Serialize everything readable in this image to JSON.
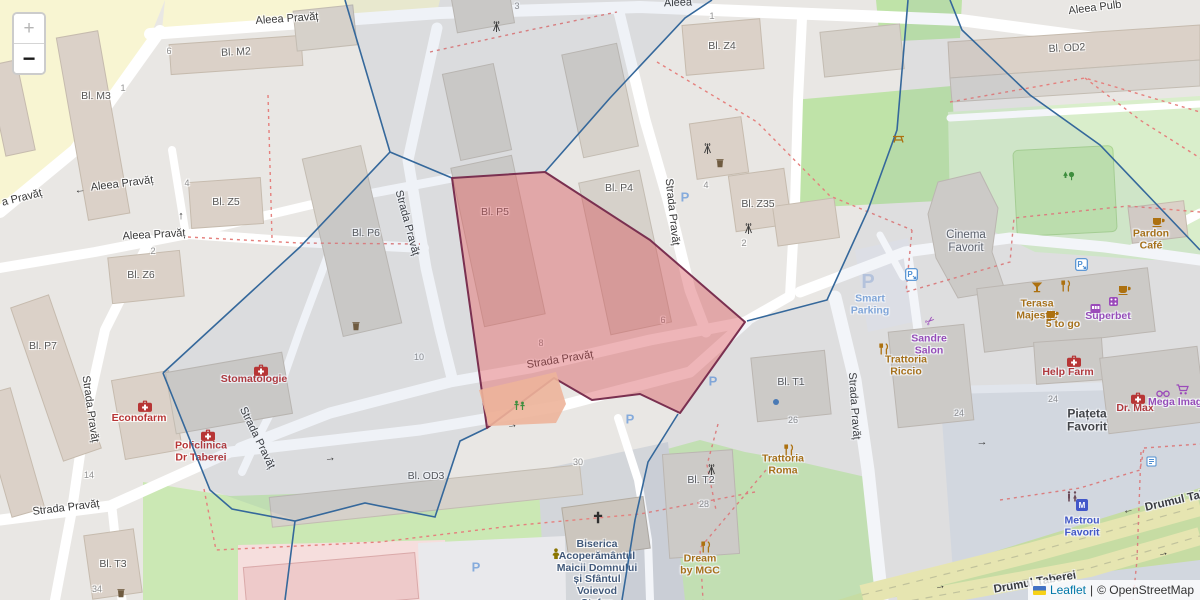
{
  "controls": {
    "zoom_in": "+",
    "zoom_out": "−"
  },
  "attribution": {
    "leaflet": "Leaflet",
    "separator": "|",
    "osm": "© OpenStreetMap"
  },
  "colors": {
    "street_label": "#383838",
    "building_label": "#575757",
    "number_gray": "#8f8f8f",
    "poi_red": "#b73535",
    "poi_orange": "#ad7110",
    "poi_purple": "#9b4bba",
    "parking_blue": "#85abdc",
    "parking_faint": "#bcc9e0",
    "metro_blue": "#4257c9",
    "church_label": "#41597a",
    "cinema_gray": "#5d6067",
    "green_icon": "#3e8e3e",
    "boundary_blue": "#35689b",
    "dashed_red": "#e5807d",
    "selection_fill": "#d64e56",
    "selection_stroke": "#7a3050",
    "leaflet_link": "#0078a8"
  },
  "street_labels": [
    {
      "n": "street-aleea-pravat-top",
      "t": "Aleea Pravăț",
      "x": 287,
      "y": 19,
      "r": -4
    },
    {
      "n": "street-aleea-pulb",
      "t": "Aleea Pulb",
      "x": 1095,
      "y": 8,
      "r": -7
    },
    {
      "n": "street-aleea-partial",
      "t": "Aleea",
      "x": 678,
      "y": 3,
      "r": -2
    },
    {
      "n": "street-a-pravat-left",
      "t": "a Pravăț",
      "x": 22,
      "y": 198,
      "r": -14
    },
    {
      "n": "street-aleea-pravat-west",
      "t": "Aleea Pravăț",
      "x": 122,
      "y": 184,
      "r": -7
    },
    {
      "n": "street-aleea-pravat-mid",
      "t": "Aleea Pravăț",
      "x": 154,
      "y": 235,
      "r": -3
    },
    {
      "n": "street-strada-pravat-left",
      "t": "Strada Pravăț",
      "x": 90,
      "y": 409,
      "r": 82
    },
    {
      "n": "street-strada-pravat-n",
      "t": "Strada Pravăț",
      "x": 407,
      "y": 223,
      "r": 75
    },
    {
      "n": "street-strada-pravat-ne",
      "t": "Strada Pravăț",
      "x": 672,
      "y": 212,
      "r": 84
    },
    {
      "n": "street-strada-pravat-h",
      "t": "Strada Pravăț",
      "x": 560,
      "y": 360,
      "r": -9
    },
    {
      "n": "street-strada-pravat-curve",
      "t": "Strada Pravăț",
      "x": 257,
      "y": 438,
      "r": 64
    },
    {
      "n": "street-strada-pravat-s",
      "t": "Strada Pravăț",
      "x": 854,
      "y": 406,
      "r": 86
    },
    {
      "n": "street-strada-pravat-sw",
      "t": "Strada Pravăț",
      "x": 66,
      "y": 508,
      "r": -7
    },
    {
      "n": "street-drumul-taberei-ne",
      "t": "Drumul Taberei",
      "x": 1186,
      "y": 499,
      "r": -13,
      "cls": "major"
    },
    {
      "n": "street-drumul-taberei-s",
      "t": "Drumul Taberei",
      "x": 1035,
      "y": 583,
      "r": -10,
      "cls": "major"
    }
  ],
  "building_labels": [
    {
      "n": "bldg-label-m2",
      "t": "Bl. M2",
      "x": 236,
      "y": 53,
      "r": -3
    },
    {
      "n": "bldg-label-m3",
      "t": "Bl. M3",
      "x": 96,
      "y": 97,
      "r": 0
    },
    {
      "n": "bldg-label-z5",
      "t": "Bl. Z5",
      "x": 226,
      "y": 203,
      "r": 0
    },
    {
      "n": "bldg-label-z6",
      "t": "Bl. Z6",
      "x": 141,
      "y": 276,
      "r": 0
    },
    {
      "n": "bldg-label-p7",
      "t": "Bl. P7",
      "x": 43,
      "y": 347,
      "r": 0
    },
    {
      "n": "bldg-label-p6",
      "t": "Bl. P6",
      "x": 366,
      "y": 234,
      "r": 0
    },
    {
      "n": "bldg-label-p5",
      "t": "Bl. P5",
      "x": 495,
      "y": 213,
      "r": 0
    },
    {
      "n": "bldg-label-p4",
      "t": "Bl. P4",
      "x": 619,
      "y": 189,
      "r": 0
    },
    {
      "n": "bldg-label-z4",
      "t": "Bl. Z4",
      "x": 722,
      "y": 47,
      "r": 0
    },
    {
      "n": "bldg-label-z35",
      "t": "Bl. Z35",
      "x": 758,
      "y": 205,
      "r": 0
    },
    {
      "n": "bldg-label-t1",
      "t": "Bl. T1",
      "x": 791,
      "y": 383,
      "r": 0
    },
    {
      "n": "bldg-label-t2",
      "t": "Bl. T2",
      "x": 701,
      "y": 481,
      "r": 0
    },
    {
      "n": "bldg-label-t3",
      "t": "Bl. T3",
      "x": 113,
      "y": 565,
      "r": 0
    },
    {
      "n": "bldg-label-od3",
      "t": "Bl. OD3",
      "x": 426,
      "y": 477,
      "r": 0
    },
    {
      "n": "bldg-label-od2",
      "t": "Bl. OD2",
      "x": 1067,
      "y": 49,
      "r": -3
    }
  ],
  "place_labels": [
    {
      "n": "place-cinema-favorit",
      "lines": [
        "Cinema",
        "Favorit"
      ],
      "x": 966,
      "y": 242
    },
    {
      "n": "place-piateta-favorit",
      "lines": [
        "Piațeta",
        "Favorit"
      ],
      "x": 1087,
      "y": 421,
      "cls": "piateta"
    }
  ],
  "poi_labels": [
    {
      "n": "poi-econofarm",
      "lines": [
        "Econofarm"
      ],
      "x": 139,
      "y": 419,
      "cls": "red"
    },
    {
      "n": "poi-stomatologie",
      "lines": [
        "Stomatologie"
      ],
      "x": 254,
      "y": 380,
      "cls": "red"
    },
    {
      "n": "poi-policlinica",
      "lines": [
        "Policlinica",
        "Dr Taberei"
      ],
      "x": 201,
      "y": 452,
      "cls": "red"
    },
    {
      "n": "poi-help-farm",
      "lines": [
        "Help Farm"
      ],
      "x": 1068,
      "y": 373,
      "cls": "red"
    },
    {
      "n": "poi-dr-max",
      "lines": [
        "Dr. Max"
      ],
      "x": 1135,
      "y": 409,
      "cls": "red"
    },
    {
      "n": "poi-trattoria-roma",
      "lines": [
        "Trattoria",
        "Roma"
      ],
      "x": 783,
      "y": 465,
      "cls": "orange"
    },
    {
      "n": "poi-trattoria-riccio",
      "lines": [
        "Trattoria",
        "Riccio"
      ],
      "x": 906,
      "y": 366,
      "cls": "orange"
    },
    {
      "n": "poi-dream-by-mgc",
      "lines": [
        "Dream",
        "by MGC"
      ],
      "x": 700,
      "y": 565,
      "cls": "orange"
    },
    {
      "n": "poi-terasa-majestic",
      "lines": [
        "Terasa",
        "Majestic"
      ],
      "x": 1037,
      "y": 310,
      "cls": "orange"
    },
    {
      "n": "poi-five-to-go",
      "lines": [
        "5 to go"
      ],
      "x": 1063,
      "y": 325,
      "cls": "orange"
    },
    {
      "n": "poi-pardon-cafe",
      "lines": [
        "Pardon",
        "Café"
      ],
      "x": 1151,
      "y": 240,
      "cls": "orange"
    },
    {
      "n": "poi-sandre-salon",
      "lines": [
        "Sandre",
        "Salon"
      ],
      "x": 929,
      "y": 345,
      "cls": "purple"
    },
    {
      "n": "poi-superbet",
      "lines": [
        "Superbet"
      ],
      "x": 1108,
      "y": 317,
      "cls": "purple"
    },
    {
      "n": "poi-mega-image",
      "lines": [
        "Mega Image"
      ],
      "x": 1178,
      "y": 403,
      "cls": "purple"
    },
    {
      "n": "poi-smart-parking",
      "lines": [
        "Smart",
        "Parking"
      ],
      "x": 870,
      "y": 305,
      "cls": "pblue"
    },
    {
      "n": "poi-metrou-favorit",
      "lines": [
        "Metrou",
        "Favorit"
      ],
      "x": 1082,
      "y": 527,
      "cls": "mblue"
    },
    {
      "n": "poi-biserica",
      "lines": [
        "Biserica",
        "Acoperământul",
        "Maicii Domnului",
        "și Sfântul",
        "Voievod",
        "Ștefan"
      ],
      "x": 597,
      "y": 574,
      "cls": "church"
    }
  ],
  "house_numbers": [
    {
      "t": "6",
      "x": 169,
      "y": 51
    },
    {
      "t": "1",
      "x": 123,
      "y": 88
    },
    {
      "t": "4",
      "x": 187,
      "y": 183
    },
    {
      "t": "2",
      "x": 153,
      "y": 251
    },
    {
      "t": "3",
      "x": 517,
      "y": 6
    },
    {
      "t": "1",
      "x": 712,
      "y": 16
    },
    {
      "t": "4",
      "x": 706,
      "y": 185
    },
    {
      "t": "2",
      "x": 744,
      "y": 243
    },
    {
      "t": "10",
      "x": 419,
      "y": 357
    },
    {
      "t": "8",
      "x": 541,
      "y": 343
    },
    {
      "t": "6",
      "x": 663,
      "y": 320
    },
    {
      "t": "30",
      "x": 578,
      "y": 462
    },
    {
      "t": "28",
      "x": 704,
      "y": 504
    },
    {
      "t": "26",
      "x": 793,
      "y": 420
    },
    {
      "t": "24",
      "x": 959,
      "y": 413
    },
    {
      "t": "24",
      "x": 1053,
      "y": 399
    },
    {
      "t": "34",
      "x": 97,
      "y": 589
    },
    {
      "t": "14",
      "x": 89,
      "y": 475
    }
  ],
  "parking_marks": [
    {
      "n": "parking-p-1",
      "t": "P",
      "x": 630,
      "y": 420
    },
    {
      "n": "parking-p-2",
      "t": "P",
      "x": 713,
      "y": 382
    },
    {
      "n": "parking-p-3",
      "t": "P",
      "x": 685,
      "y": 198
    },
    {
      "n": "parking-p-4",
      "t": "P",
      "x": 476,
      "y": 568
    },
    {
      "n": "parking-p-smart",
      "t": "P",
      "x": 868,
      "y": 282,
      "cls": "faint"
    }
  ],
  "icons": [
    {
      "n": "econofarm-pharmacy-icon",
      "ty": "medical",
      "x": 138,
      "y": 400
    },
    {
      "n": "stomatologie-dentist-icon",
      "ty": "medical",
      "x": 254,
      "y": 364
    },
    {
      "n": "policlinica-clinic-icon",
      "ty": "medical",
      "x": 201,
      "y": 429
    },
    {
      "n": "help-farm-pharmacy-icon",
      "ty": "medical",
      "x": 1067,
      "y": 355
    },
    {
      "n": "dr-max-pharmacy-icon",
      "ty": "medical",
      "x": 1131,
      "y": 392
    },
    {
      "n": "pardon-cafe-icon",
      "ty": "cafe",
      "x": 1152,
      "y": 216
    },
    {
      "n": "five-to-go-cafe-icon",
      "ty": "cafe",
      "x": 1046,
      "y": 309
    },
    {
      "n": "superbet-cafe-icon",
      "ty": "cafe",
      "x": 1118,
      "y": 284
    },
    {
      "n": "terasa-majestic-bar-icon",
      "ty": "bar",
      "x": 1031,
      "y": 281
    },
    {
      "n": "mall-restaurant-icon",
      "ty": "restaurant",
      "x": 1060,
      "y": 280
    },
    {
      "n": "trattoria-roma-restaurant-icon",
      "ty": "restaurant",
      "x": 783,
      "y": 444
    },
    {
      "n": "trattoria-riccio-restaurant-icon",
      "ty": "restaurant",
      "x": 878,
      "y": 343
    },
    {
      "n": "dream-by-mgc-restaurant-icon",
      "ty": "restaurant",
      "x": 700,
      "y": 541
    },
    {
      "n": "sandre-salon-scissors-icon",
      "ty": "scissors",
      "x": 930,
      "y": 321
    },
    {
      "n": "superbet-slot-icon",
      "ty": "slot",
      "x": 1090,
      "y": 303
    },
    {
      "n": "superbet-gaming-icon",
      "ty": "gaming",
      "x": 1108,
      "y": 296
    },
    {
      "n": "optician-glasses-icon",
      "ty": "glasses",
      "x": 1156,
      "y": 389
    },
    {
      "n": "mega-image-cart-icon",
      "ty": "cart",
      "x": 1176,
      "y": 384
    },
    {
      "n": "church-cross-icon",
      "ty": "cross",
      "x": 598,
      "y": 518
    },
    {
      "n": "community-centre-icon",
      "ty": "person",
      "x": 551,
      "y": 548
    },
    {
      "n": "antenna-icon-1",
      "ty": "antenna",
      "x": 491,
      "y": 20
    },
    {
      "n": "antenna-icon-2",
      "ty": "antenna",
      "x": 702,
      "y": 142
    },
    {
      "n": "antenna-icon-3",
      "ty": "antenna",
      "x": 743,
      "y": 222
    },
    {
      "n": "antenna-icon-4",
      "ty": "antenna",
      "x": 706,
      "y": 463
    },
    {
      "n": "trees-icon",
      "ty": "tree",
      "x": 1062,
      "y": 171
    },
    {
      "n": "picnic-icon",
      "ty": "picnic",
      "x": 892,
      "y": 134
    },
    {
      "n": "playground-icon",
      "ty": "playground",
      "x": 513,
      "y": 400
    },
    {
      "n": "waste-basket-icon-1",
      "ty": "waste",
      "x": 716,
      "y": 158
    },
    {
      "n": "waste-basket-icon-2",
      "ty": "waste",
      "x": 117,
      "y": 588
    },
    {
      "n": "waste-basket-icon-3",
      "ty": "waste",
      "x": 352,
      "y": 321
    },
    {
      "n": "toilets-icon",
      "ty": "toilets",
      "x": 1066,
      "y": 491
    },
    {
      "n": "metro-station-icon",
      "ty": "metro",
      "x": 1082,
      "y": 505
    },
    {
      "n": "parking-entrance-icon-1",
      "ty": "parkarrow",
      "x": 905,
      "y": 268
    },
    {
      "n": "parking-entrance-icon-2",
      "ty": "parkarrow",
      "x": 1075,
      "y": 258
    },
    {
      "n": "node-dot-icon",
      "ty": "dot",
      "x": 776,
      "y": 402
    },
    {
      "n": "kiosk-icon",
      "ty": "info",
      "x": 1146,
      "y": 456
    },
    {
      "n": "oneway-left-icon-1",
      "ty": "arrow",
      "g": "←",
      "x": 80,
      "y": 190,
      "r": -7
    },
    {
      "n": "oneway-up-icon",
      "ty": "arrow",
      "g": "↑",
      "x": 181,
      "y": 216,
      "r": 0
    },
    {
      "n": "oneway-right-icon-1",
      "ty": "arrow",
      "g": "→",
      "x": 330,
      "y": 458,
      "r": -8
    },
    {
      "n": "oneway-right-icon-2",
      "ty": "arrow",
      "g": "→",
      "x": 512,
      "y": 425,
      "r": -10
    },
    {
      "n": "oneway-left-icon-2",
      "ty": "arrow",
      "g": "←",
      "x": 1128,
      "y": 510,
      "r": -13
    },
    {
      "n": "oneway-right-icon-3",
      "ty": "arrow",
      "g": "→",
      "x": 1163,
      "y": 553,
      "r": -13
    },
    {
      "n": "oneway-right-icon-4",
      "ty": "arrow",
      "g": "→",
      "x": 940,
      "y": 586,
      "r": -12
    },
    {
      "n": "oneway-right-icon-5",
      "ty": "arrow",
      "g": "→",
      "x": 982,
      "y": 442,
      "r": 0
    }
  ]
}
